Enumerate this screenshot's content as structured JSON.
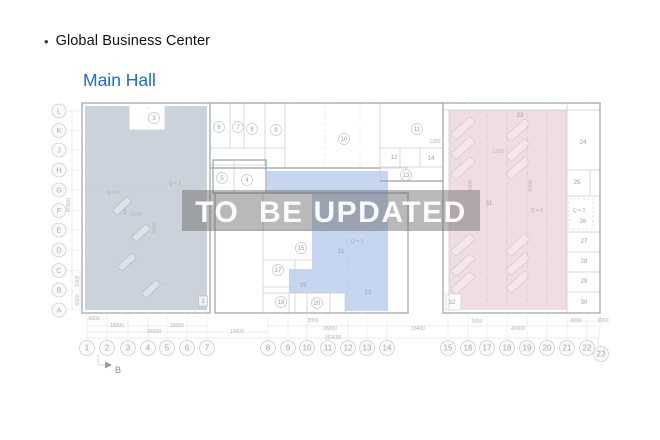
{
  "header": {
    "bullet": "•",
    "title": "Global Business Center",
    "subtitle": "Main Hall"
  },
  "watermark": {
    "text": "TO  BE UPDATED"
  },
  "colors": {
    "accent_blue": "#1b6dd0",
    "region_left": "#cbd2dc",
    "region_middle": "#c6d6f1",
    "region_right": "#f0dce3",
    "watermark_band": "rgba(107,107,107,0.47)"
  },
  "plan": {
    "section_marker": "B",
    "grid_rows": [
      {
        "label": "L",
        "y": 111
      },
      {
        "label": "K",
        "y": 130.5
      },
      {
        "label": "J",
        "y": 150
      },
      {
        "label": "H",
        "y": 170
      },
      {
        "label": "G",
        "y": 190
      },
      {
        "label": "F",
        "y": 210.5
      },
      {
        "label": "E",
        "y": 230
      },
      {
        "label": "D",
        "y": 250
      },
      {
        "label": "C",
        "y": 270.5
      },
      {
        "label": "B",
        "y": 290
      },
      {
        "label": "A",
        "y": 310
      }
    ],
    "grid_cols": [
      {
        "label": "1",
        "x": 87,
        "y": 348
      },
      {
        "label": "2",
        "x": 107,
        "y": 348
      },
      {
        "label": "3",
        "x": 128,
        "y": 348
      },
      {
        "label": "4",
        "x": 148,
        "y": 348
      },
      {
        "label": "5",
        "x": 167,
        "y": 348
      },
      {
        "label": "6",
        "x": 187,
        "y": 348
      },
      {
        "label": "7",
        "x": 207,
        "y": 348
      },
      {
        "label": "8",
        "x": 268,
        "y": 348
      },
      {
        "label": "9",
        "x": 288,
        "y": 348
      },
      {
        "label": "10",
        "x": 307,
        "y": 348
      },
      {
        "label": "11",
        "x": 328,
        "y": 348
      },
      {
        "label": "12",
        "x": 348,
        "y": 348
      },
      {
        "label": "13",
        "x": 367,
        "y": 348
      },
      {
        "label": "14",
        "x": 387,
        "y": 348
      },
      {
        "label": "15",
        "x": 448,
        "y": 348
      },
      {
        "label": "16",
        "x": 468,
        "y": 348
      },
      {
        "label": "17",
        "x": 487,
        "y": 348
      },
      {
        "label": "18",
        "x": 507,
        "y": 348
      },
      {
        "label": "19",
        "x": 527,
        "y": 348
      },
      {
        "label": "20",
        "x": 547,
        "y": 348
      },
      {
        "label": "21",
        "x": 567,
        "y": 348
      },
      {
        "label": "22",
        "x": 587,
        "y": 348
      },
      {
        "label": "23",
        "x": 601,
        "y": 354,
        "offset": true
      }
    ],
    "rooms": [
      {
        "label": "1",
        "x": 203,
        "y": 301,
        "style": "box"
      },
      {
        "label": "2",
        "x": 125,
        "y": 212,
        "style": "plain"
      },
      {
        "label": "3",
        "x": 154,
        "y": 118,
        "style": "circle"
      },
      {
        "label": "4",
        "x": 247,
        "y": 180,
        "style": "circle"
      },
      {
        "label": "5",
        "x": 222,
        "y": 178,
        "style": "circle"
      },
      {
        "label": "6",
        "x": 219,
        "y": 127,
        "style": "circle"
      },
      {
        "label": "7",
        "x": 238,
        "y": 127,
        "style": "circle"
      },
      {
        "label": "8",
        "x": 252,
        "y": 129,
        "style": "circle"
      },
      {
        "label": "9",
        "x": 276,
        "y": 130,
        "style": "circle"
      },
      {
        "label": "10",
        "x": 344,
        "y": 139,
        "style": "circle"
      },
      {
        "label": "11",
        "x": 417,
        "y": 129,
        "style": "circle"
      },
      {
        "label": "12",
        "x": 394,
        "y": 157,
        "style": "plain"
      },
      {
        "label": "13",
        "x": 406,
        "y": 175,
        "style": "circle"
      },
      {
        "label": "14",
        "x": 431,
        "y": 158,
        "style": "plain"
      },
      {
        "label": "15",
        "x": 301,
        "y": 248,
        "style": "circle"
      },
      {
        "label": "17",
        "x": 278,
        "y": 270,
        "style": "circle"
      },
      {
        "label": "18",
        "x": 281,
        "y": 302,
        "style": "circle"
      },
      {
        "label": "19",
        "x": 303,
        "y": 285,
        "style": "plain"
      },
      {
        "label": "20",
        "x": 317,
        "y": 303,
        "style": "circle"
      },
      {
        "label": "21",
        "x": 341,
        "y": 251,
        "style": "plain"
      },
      {
        "label": "22",
        "x": 368,
        "y": 292,
        "style": "plain"
      },
      {
        "label": "23",
        "x": 520,
        "y": 115,
        "style": "plain"
      },
      {
        "label": "24",
        "x": 583,
        "y": 142,
        "style": "plain"
      },
      {
        "label": "25",
        "x": 577,
        "y": 182,
        "style": "plain"
      },
      {
        "label": "26",
        "x": 583,
        "y": 221,
        "style": "plain"
      },
      {
        "label": "27",
        "x": 584,
        "y": 241,
        "style": "plain"
      },
      {
        "label": "28",
        "x": 584,
        "y": 261,
        "style": "plain"
      },
      {
        "label": "29",
        "x": 584,
        "y": 281,
        "style": "plain"
      },
      {
        "label": "30",
        "x": 584,
        "y": 302,
        "style": "plain"
      },
      {
        "label": "31",
        "x": 489,
        "y": 203,
        "style": "plain"
      },
      {
        "label": "32",
        "x": 452,
        "y": 302,
        "style": "plain"
      }
    ],
    "dims": [
      {
        "text": "6000",
        "x": 94,
        "y": 320
      },
      {
        "text": "2000",
        "x": 313,
        "y": 322
      },
      {
        "text": "1000",
        "x": 477,
        "y": 323
      },
      {
        "text": "6000",
        "x": 576,
        "y": 322
      },
      {
        "text": "3000",
        "x": 603,
        "y": 322
      },
      {
        "text": "18000",
        "x": 117,
        "y": 327
      },
      {
        "text": "18000",
        "x": 177,
        "y": 327
      },
      {
        "text": "36000",
        "x": 330,
        "y": 330
      },
      {
        "text": "18400",
        "x": 418,
        "y": 330
      },
      {
        "text": "45000",
        "x": 518,
        "y": 330
      },
      {
        "text": "36000",
        "x": 154,
        "y": 333
      },
      {
        "text": "18000",
        "x": 237,
        "y": 333
      },
      {
        "text": "153600",
        "x": 333,
        "y": 339
      },
      {
        "text": "60000",
        "x": 70,
        "y": 205,
        "rot": -90
      },
      {
        "text": "6000",
        "x": 79,
        "y": 281,
        "rot": -90
      },
      {
        "text": "6000",
        "x": 79,
        "y": 300,
        "rot": -90
      },
      {
        "text": "2000",
        "x": 136,
        "y": 216
      },
      {
        "text": "2000",
        "x": 156,
        "y": 228,
        "rot": -90
      },
      {
        "text": "1300",
        "x": 435,
        "y": 143
      },
      {
        "text": "1300",
        "x": 498,
        "y": 153
      },
      {
        "text": "6000",
        "x": 472,
        "y": 186,
        "rot": -90
      },
      {
        "text": "6000",
        "x": 532,
        "y": 186,
        "rot": -90
      }
    ],
    "notes": [
      {
        "text": "Q = 3",
        "x": 113,
        "y": 194
      },
      {
        "text": "Q = 3",
        "x": 175,
        "y": 185
      },
      {
        "text": "Q = 3",
        "x": 357,
        "y": 243
      },
      {
        "text": "Q = 3",
        "x": 537,
        "y": 212
      },
      {
        "text": "Q = 3",
        "x": 579,
        "y": 212
      }
    ]
  }
}
